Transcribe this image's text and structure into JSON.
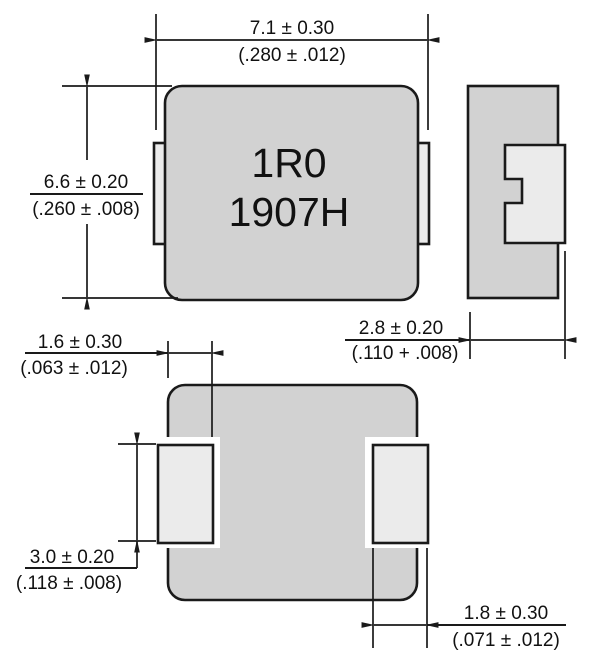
{
  "drawing": {
    "type": "component-dimension-drawing",
    "component": "shielded power inductor (SMD)",
    "front_view": {
      "marking_line1": "1R0",
      "marking_line2": "1907H"
    },
    "dimensions": {
      "body_width": {
        "mm": "7.1 ± 0.30",
        "inch": "(.280 ± .012)"
      },
      "body_height": {
        "mm": "6.6 ± 0.20",
        "inch": "(.260 ± .008)"
      },
      "body_thickness": {
        "mm": "2.8 ± 0.20",
        "inch": "(.110 + .008)"
      },
      "terminal_inset": {
        "mm": "1.6 ± 0.30",
        "inch": "(.063 ± .012)"
      },
      "terminal_height": {
        "mm": "3.0 ± 0.20",
        "inch": "(.118 ± .008)"
      },
      "terminal_width": {
        "mm": "1.8 ± 0.30",
        "inch": "(.071 ± .012)"
      }
    },
    "colors": {
      "body_fill": "#d2d2d2",
      "terminal_fill": "#ebebeb",
      "line": "#1a1a1a",
      "background": "#ffffff"
    }
  }
}
